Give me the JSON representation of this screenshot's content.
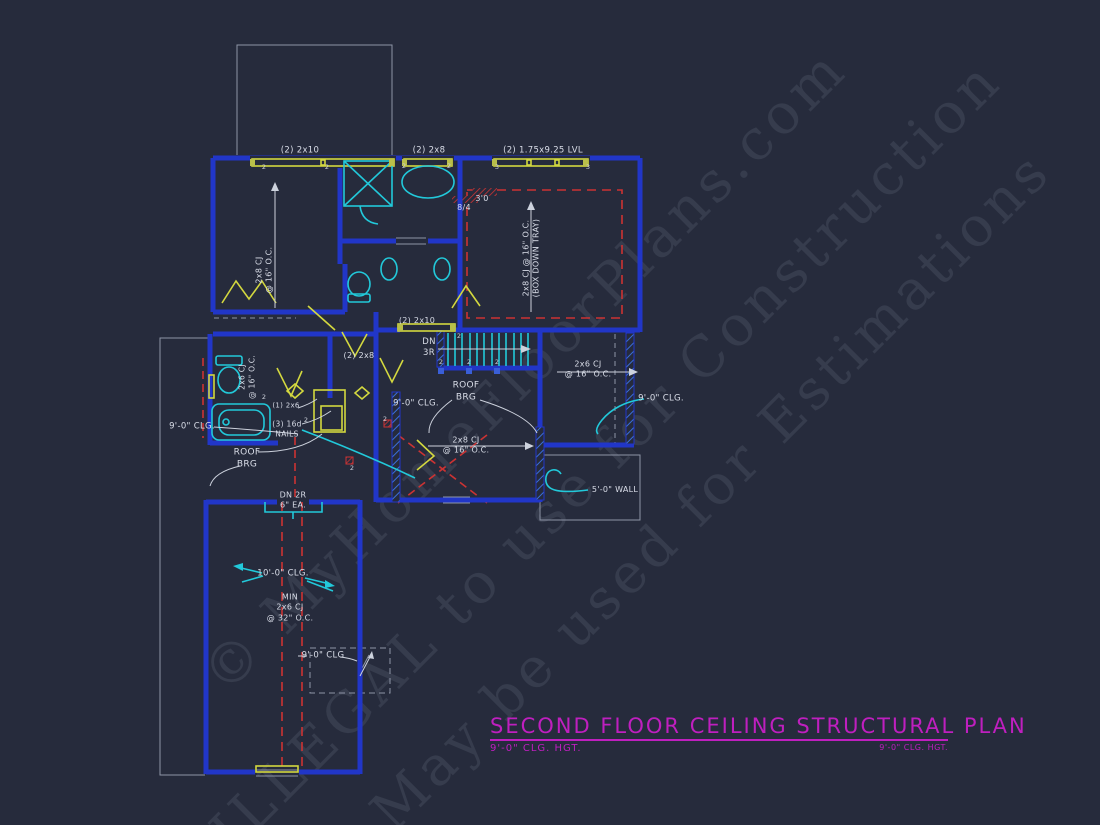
{
  "title_block": {
    "title": "SECOND FLOOR CEILING STRUCTURAL PLAN",
    "subtitle_left": "9'-0\" CLG. HGT.",
    "subtitle_right": "9'-0\" CLG. HGT."
  },
  "watermark": {
    "lines": [
      "© MyHomeFloorPlans.com",
      "ILLEGAL to use for Construction",
      "May be used for Estimations"
    ]
  },
  "colors": {
    "background": "#262b3c",
    "wall_blue": "#2136c8",
    "fixture_cyan": "#22c9da",
    "beam_yellow": "#d3d83f",
    "dashed_red": "#cc3333",
    "title_magenta": "#bf1fbf",
    "line_gray": "#cdd2dd"
  },
  "labels": [
    {
      "id": "beam-top-left",
      "text": "(2) 2x10",
      "x": 300,
      "y": 151,
      "size": 8.5
    },
    {
      "id": "beam-top-mid",
      "text": "(2) 2x8",
      "x": 429,
      "y": 151,
      "size": 8.5
    },
    {
      "id": "beam-top-right",
      "text": "(2) 1.75x9.25 LVL",
      "x": 543,
      "y": 151,
      "size": 8.5
    },
    {
      "id": "joists-left-room",
      "text": "2x8 CJ\n@ 16\" O.C.",
      "x": 265,
      "y": 270,
      "size": 8,
      "rot": true
    },
    {
      "id": "joists-tray-room",
      "text": "2x8 CJ @ 16\" O.C.\n(BOX DOWN TRAY)",
      "x": 532,
      "y": 258,
      "size": 8,
      "rot": true
    },
    {
      "id": "fireplace-note-a",
      "text": "8/4",
      "x": 464,
      "y": 208,
      "size": 8
    },
    {
      "id": "fireplace-note-b",
      "text": "3'0",
      "x": 482,
      "y": 199,
      "size": 8
    },
    {
      "id": "beam-stairs",
      "text": "(2) 2x10",
      "x": 417,
      "y": 321,
      "size": 8
    },
    {
      "id": "stairs-dn-3r",
      "text": "DN\n3R",
      "x": 429,
      "y": 348,
      "size": 8.5
    },
    {
      "id": "beam-mid",
      "text": "(2) 2x8",
      "x": 359,
      "y": 356,
      "size": 8
    },
    {
      "id": "roof-brg-center",
      "text": "ROOF\nBRG",
      "x": 466,
      "y": 392,
      "size": 9
    },
    {
      "id": "clg-hall",
      "text": "9'-0\" CLG.",
      "x": 416,
      "y": 404,
      "size": 8.5
    },
    {
      "id": "joists-right",
      "text": "2x6 CJ\n@ 16\" O.C.",
      "x": 588,
      "y": 370,
      "size": 8
    },
    {
      "id": "clg-right",
      "text": "9'-0\" CLG.",
      "x": 661,
      "y": 399,
      "size": 8.5
    },
    {
      "id": "joists-left-bath",
      "text": "2x6 CJ\n@ 16\" O.C.",
      "x": 247,
      "y": 377,
      "size": 7.5,
      "rot": true
    },
    {
      "id": "clg-left",
      "text": "9'-0\" CLG.",
      "x": 192,
      "y": 427,
      "size": 8.5
    },
    {
      "id": "nail-note-a",
      "text": "(1) 2x6",
      "x": 286,
      "y": 406,
      "size": 7
    },
    {
      "id": "nail-note-b",
      "text": "(3) 16d\nNAILS",
      "x": 287,
      "y": 429,
      "size": 7.5
    },
    {
      "id": "roof-brg-left",
      "text": "ROOF\nBRG",
      "x": 247,
      "y": 459,
      "size": 9
    },
    {
      "id": "joists-mid-low",
      "text": "2x8 CJ\n@ 16\" O.C.",
      "x": 466,
      "y": 446,
      "size": 8
    },
    {
      "id": "wall-height",
      "text": "5'-0\" WALL",
      "x": 615,
      "y": 490,
      "size": 8
    },
    {
      "id": "stairs-dn-2r",
      "text": "DN 2R\n6\" EA.",
      "x": 293,
      "y": 501,
      "size": 8
    },
    {
      "id": "clg-garage",
      "text": "10'-0\" CLG.",
      "x": 283,
      "y": 574,
      "size": 8.5
    },
    {
      "id": "joists-garage",
      "text": "MIN\n2x6 CJ\n@ 32\" O.C.",
      "x": 290,
      "y": 608,
      "size": 8
    },
    {
      "id": "clg-attic",
      "text": "9'-0\" CLG",
      "x": 323,
      "y": 656,
      "size": 8.5
    }
  ],
  "post_marks": [
    {
      "text": "2",
      "x": 264,
      "y": 167
    },
    {
      "text": "2",
      "x": 327,
      "y": 167
    },
    {
      "text": "2",
      "x": 404,
      "y": 166
    },
    {
      "text": "2",
      "x": 449,
      "y": 166
    },
    {
      "text": "3",
      "x": 497,
      "y": 167
    },
    {
      "text": "3",
      "x": 588,
      "y": 167
    },
    {
      "text": "2",
      "x": 459,
      "y": 336
    },
    {
      "text": "2",
      "x": 441,
      "y": 362
    },
    {
      "text": "2",
      "x": 469,
      "y": 362
    },
    {
      "text": "2",
      "x": 497,
      "y": 362
    },
    {
      "text": "2",
      "x": 264,
      "y": 397
    },
    {
      "text": "2",
      "x": 306,
      "y": 420
    },
    {
      "text": "2",
      "x": 385,
      "y": 419
    },
    {
      "text": "2",
      "x": 352,
      "y": 468
    }
  ]
}
